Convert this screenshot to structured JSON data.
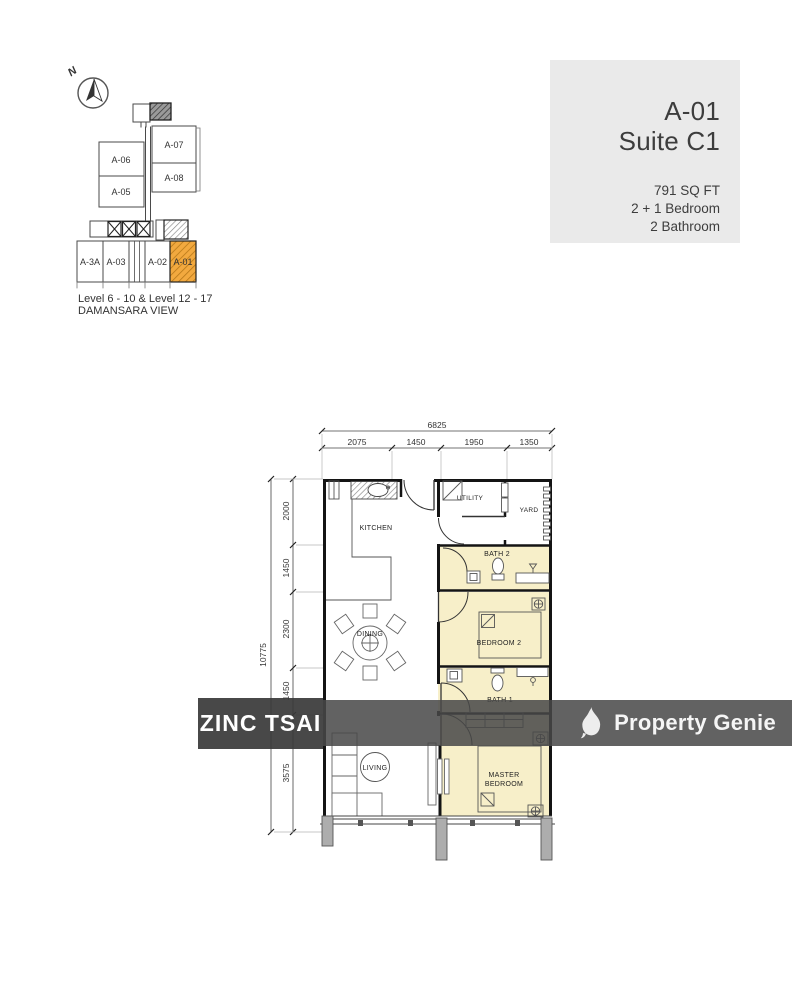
{
  "header_card": {
    "unit": "A-01",
    "suite": "Suite C1",
    "area": "791 SQ FT",
    "bedrooms": "2 + 1 Bedroom",
    "bathrooms": "2 Bathroom"
  },
  "key_plan": {
    "north_label": "N",
    "units": [
      "A-06",
      "A-07",
      "A-05",
      "A-08",
      "A-3A",
      "A-03",
      "A-02",
      "A-01"
    ],
    "highlighted_unit": "A-01",
    "caption_levels": "Level 6 - 10 & Level 12 - 17",
    "caption_name": "DAMANSARA VIEW"
  },
  "floor_plan": {
    "rooms": {
      "kitchen": "KITCHEN",
      "utility": "UTILITY",
      "yard": "YARD",
      "bath2": "BATH 2",
      "dining": "DINING",
      "bedroom2": "BEDROOM 2",
      "bath1": "BATH 1",
      "living": "LIVING",
      "master_line1": "MASTER",
      "master_line2": "BEDROOM"
    },
    "dims": {
      "top_total": "6825",
      "top_segments": [
        "2075",
        "1450",
        "1950",
        "1350"
      ],
      "left_total": "10775",
      "left_segments": [
        "2000",
        "1450",
        "2300",
        "1450",
        "3575"
      ]
    },
    "colors": {
      "room_highlight": "#f7efc9",
      "unit_highlight": "#f2a93f",
      "card_bg": "#eaeaea",
      "watermark_bg": "#4a4a4a"
    }
  },
  "watermarks": {
    "agent": "ZINC TSAI",
    "brand": "Property Genie"
  }
}
